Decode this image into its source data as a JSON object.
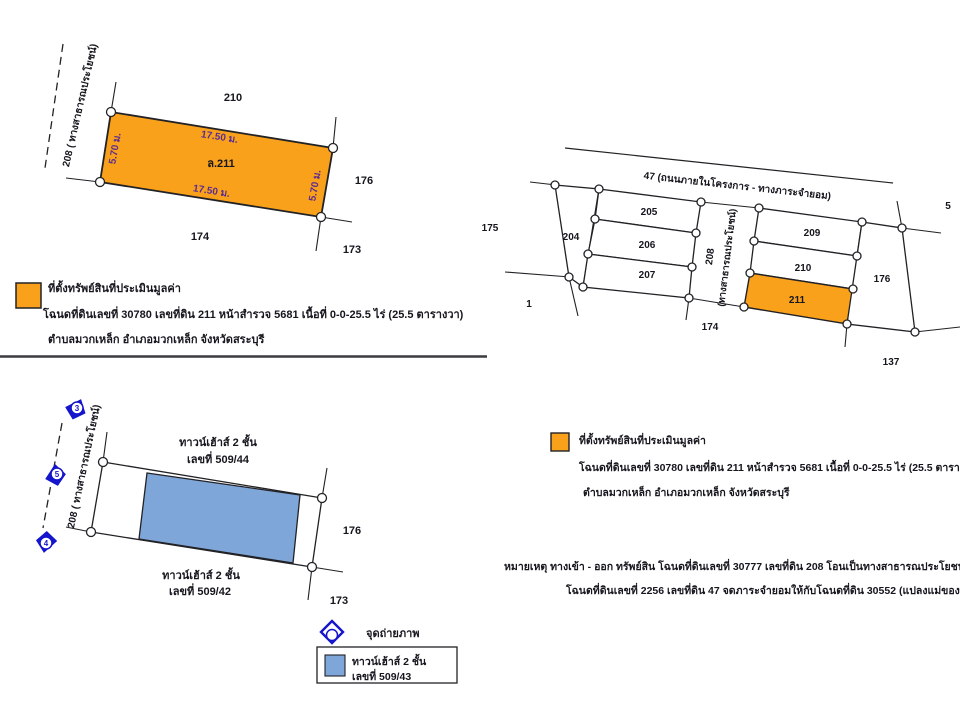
{
  "colors": {
    "highlight_orange": "#F9A11B",
    "townhouse_blue": "#7EA6D9",
    "marker_blue": "#1515CC",
    "dimension_purple": "#5B2D91",
    "line_black": "#222226"
  },
  "detail_plot": {
    "road_label": "208 ( ทางสาธารณประโยชน์)",
    "parcel_id": "ล.211",
    "dim_top": "17.50 ม.",
    "dim_bottom": "17.50 ม.",
    "dim_left": "5.70 ม.",
    "dim_right": "5.70 ม.",
    "neighbors": {
      "top": "210",
      "right": "176",
      "bottom": "174",
      "bottom_right": "173"
    }
  },
  "property_legend": {
    "title": "ที่ตั้งทรัพย์สินที่ประเมินมูลค่า",
    "deed_info": "โฉนดที่ดินเลขที่ 30780 เลขที่ดิน 211 หน้าสำรวจ 5681 เนื้อที่ 0-0-25.5 ไร่ (25.5 ตารางวา)",
    "location": "ตำบลมวกเหล็ก  อำเภอมวกเหล็ก  จังหวัดสระบุรี"
  },
  "overview_map": {
    "road_top": "47 (ถนนภายในโครงการ - ทางภาระจำยอม)",
    "road_mid_no": "208",
    "road_mid_name": "(ทางสาธารณประโยชน์)",
    "labels": {
      "n175": "175",
      "n204": "204",
      "n205": "205",
      "n206": "206",
      "n207": "207",
      "n1": "1",
      "n174": "174",
      "n209": "209",
      "n210": "210",
      "n211": "211",
      "n176": "176",
      "n5": "5",
      "n137": "137"
    }
  },
  "note": {
    "line1": "หมายเหตุ ทางเข้า - ออก ทรัพย์สิน โฉนดที่ดินเลขที่ 30777 เลขที่ดิน 208 โอนเป็นทางสาธารณประโยชน์แล้ว",
    "line2": "โฉนดที่ดินเลขที่ 2256 เลขที่ดิน 47 จดภาระจำยอมให้กับโฉนดที่ดิน 30552 (แปลงแม่ของทรัพย์สินแล้ว)"
  },
  "townhouse_plot": {
    "road_label": "208 ( ทางสาธารณประโยชน์)",
    "top_house_line1": "ทาวน์เฮ้าส์ 2 ชั้น",
    "top_house_line2": "เลขที่ 509/44",
    "bottom_house_line1": "ทาวน์เฮ้าส์ 2 ชั้น",
    "bottom_house_line2": "เลขที่ 509/42",
    "neighbor_right": "176",
    "neighbor_bottom_right": "173",
    "photo_markers": [
      "3",
      "5",
      "4"
    ]
  },
  "photo_legend": {
    "label": "จุดถ่ายภาพ",
    "box_line1": "ทาวน์เฮ้าส์ 2 ชั้น",
    "box_line2": "เลขที่ 509/43"
  }
}
